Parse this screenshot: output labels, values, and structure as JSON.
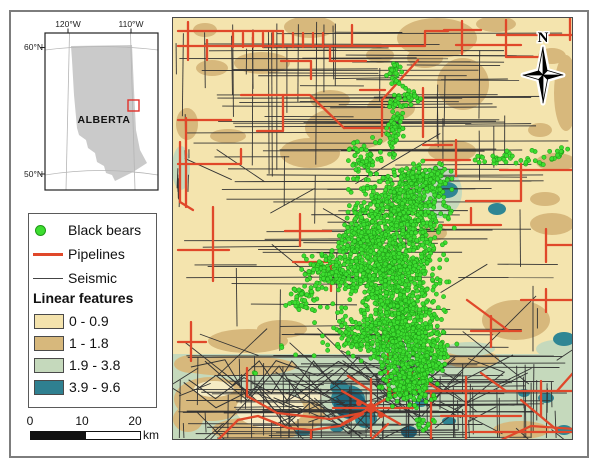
{
  "figure": {
    "border_color": "#7d7d7d",
    "background": "#ffffff"
  },
  "north": {
    "label": "N"
  },
  "inset": {
    "labels": {
      "lon_left": "120°W",
      "lon_right": "110°W",
      "lat_top": "60°N",
      "lat_bottom": "50°N",
      "province": "ALBERTA"
    },
    "province_fill": "#cacaca",
    "graticule_color": "#b5b5b5",
    "study_area_color": "#e0302a",
    "geometry": {
      "box": [
        45,
        33,
        113,
        157
      ],
      "alberta": [
        [
          71,
          46
        ],
        [
          132,
          45
        ],
        [
          134,
          90
        ],
        [
          136,
          130
        ],
        [
          140,
          150
        ],
        [
          147,
          163
        ],
        [
          133,
          172
        ],
        [
          115,
          181
        ],
        [
          112,
          175
        ],
        [
          106,
          173
        ],
        [
          104,
          166
        ],
        [
          97,
          162
        ],
        [
          95,
          153
        ],
        [
          88,
          148
        ],
        [
          86,
          140
        ],
        [
          79,
          135
        ],
        [
          77,
          128
        ],
        [
          74,
          95
        ],
        [
          72,
          60
        ]
      ],
      "study_rect": [
        128,
        100,
        11,
        11
      ]
    }
  },
  "legend": {
    "items": [
      {
        "type": "dot",
        "label": "Black bears",
        "color": "#3ddd30",
        "outline": "#1f9917"
      },
      {
        "type": "line",
        "label": "Pipelines",
        "color": "#e0482a",
        "thickness": 3
      },
      {
        "type": "line",
        "label": "Seismic",
        "color": "#444444",
        "thickness": 1
      }
    ],
    "ramp_title": "Linear features",
    "ramp": [
      {
        "label": "0 - 0.9",
        "color": "#f4e3ad"
      },
      {
        "label": "1 - 1.8",
        "color": "#d7b87c"
      },
      {
        "label": "1.9 - 3.8",
        "color": "#c5d9bc"
      },
      {
        "label": "3.9 - 9.6",
        "color": "#2f8090"
      }
    ]
  },
  "scalebar": {
    "ticks": [
      "0",
      "10",
      "20"
    ],
    "unit": "km"
  },
  "map": {
    "x": 172,
    "y": 17,
    "w": 401,
    "h": 423,
    "bg": "#f4e4ae",
    "tan": "#d7b87c",
    "green": "#c5d9bc",
    "teal": "#2f8694",
    "dark_teal": "#1c647b",
    "cream": "#f6ecc4",
    "pipeline_color": "#e0482a",
    "seismic_color": "#333333",
    "bear_fill": "#3ddd30",
    "bear_stroke": "#1f9917",
    "seed": 42,
    "green_band": [
      172,
      354,
      401,
      86
    ],
    "tan_patches": [
      [
        437,
        38,
        40,
        20
      ],
      [
        463,
        84,
        26,
        26
      ],
      [
        310,
        27,
        26,
        11
      ],
      [
        262,
        63,
        28,
        11
      ],
      [
        212,
        68,
        16,
        8
      ],
      [
        496,
        24,
        20,
        8
      ],
      [
        566,
        93,
        12,
        38
      ],
      [
        552,
        56,
        14,
        8
      ],
      [
        350,
        128,
        45,
        22
      ],
      [
        310,
        153,
        30,
        15
      ],
      [
        391,
        108,
        24,
        13
      ],
      [
        228,
        136,
        18,
        7
      ],
      [
        452,
        151,
        24,
        11
      ],
      [
        556,
        162,
        20,
        9
      ],
      [
        545,
        199,
        15,
        7
      ],
      [
        187,
        124,
        11,
        16
      ],
      [
        516,
        320,
        34,
        20
      ],
      [
        552,
        224,
        22,
        11
      ],
      [
        248,
        341,
        40,
        12
      ],
      [
        192,
        364,
        18,
        9
      ],
      [
        282,
        329,
        25,
        9
      ],
      [
        211,
        399,
        37,
        22
      ],
      [
        256,
        430,
        44,
        13
      ],
      [
        301,
        414,
        24,
        16
      ],
      [
        188,
        419,
        15,
        13
      ],
      [
        471,
        359,
        28,
        9
      ],
      [
        521,
        430,
        28,
        9
      ],
      [
        237,
        366,
        60,
        10
      ],
      [
        425,
        58,
        18,
        10
      ],
      [
        330,
        100,
        20,
        10
      ],
      [
        205,
        30,
        12,
        7
      ],
      [
        540,
        130,
        12,
        7
      ],
      [
        433,
        233,
        14,
        8
      ],
      [
        380,
        55,
        14,
        8
      ]
    ],
    "green_patches": [
      [
        181,
        168,
        9,
        22
      ],
      [
        438,
        192,
        24,
        26
      ],
      [
        556,
        349,
        20,
        9
      ],
      [
        400,
        350,
        30,
        8
      ],
      [
        470,
        349,
        25,
        7
      ]
    ],
    "cream_patches": [
      [
        270,
        409,
        34,
        19
      ],
      [
        214,
        389,
        20,
        8
      ],
      [
        310,
        396,
        12,
        6
      ]
    ],
    "teal_patches": [
      [
        348,
        399,
        17,
        14
      ],
      [
        366,
        419,
        11,
        9
      ],
      [
        339,
        387,
        9,
        7
      ],
      [
        497,
        209,
        9,
        6
      ],
      [
        447,
        190,
        11,
        8
      ],
      [
        564,
        339,
        11,
        7
      ],
      [
        546,
        398,
        8,
        5
      ],
      [
        421,
        403,
        6,
        4
      ],
      [
        449,
        421,
        7,
        4
      ],
      [
        303,
        432,
        8,
        4
      ],
      [
        524,
        393,
        6,
        4
      ],
      [
        564,
        430,
        8,
        5
      ],
      [
        337,
        428,
        7,
        4
      ]
    ],
    "dark_teal_patches": [
      [
        350,
        405,
        16,
        14
      ],
      [
        409,
        432,
        8,
        6
      ]
    ],
    "pipelines": [
      [
        178,
        46,
        392,
        46
      ],
      [
        178,
        31,
        283,
        31
      ],
      [
        188,
        22,
        188,
        60
      ],
      [
        207,
        40,
        207,
        60
      ],
      [
        233,
        33,
        233,
        47
      ],
      [
        243,
        33,
        243,
        47
      ],
      [
        253,
        33,
        253,
        47
      ],
      [
        263,
        33,
        263,
        47
      ],
      [
        273,
        33,
        273,
        47
      ],
      [
        283,
        33,
        283,
        47
      ],
      [
        293,
        33,
        293,
        47
      ],
      [
        303,
        33,
        303,
        47
      ],
      [
        313,
        33,
        313,
        47
      ],
      [
        323,
        33,
        323,
        47
      ],
      [
        330,
        46,
        330,
        61,
        366,
        61
      ],
      [
        352,
        25,
        352,
        46
      ],
      [
        392,
        46,
        425,
        46,
        425,
        31,
        448,
        31
      ],
      [
        418,
        60,
        382,
        100,
        382,
        136
      ],
      [
        281,
        61,
        311,
        61,
        311,
        79
      ],
      [
        241,
        95,
        310,
        95,
        344,
        128
      ],
      [
        283,
        95,
        283,
        131,
        257,
        131
      ],
      [
        344,
        128,
        391,
        128
      ],
      [
        360,
        90,
        385,
        90
      ],
      [
        178,
        120,
        231,
        120
      ],
      [
        186,
        118,
        186,
        207
      ],
      [
        178,
        164,
        241,
        164,
        241,
        149
      ],
      [
        213,
        207,
        213,
        281
      ],
      [
        178,
        250,
        229,
        250
      ],
      [
        497,
        35,
        575,
        35
      ],
      [
        506,
        20,
        506,
        57,
        541,
        57
      ],
      [
        462,
        21,
        462,
        54
      ],
      [
        444,
        30,
        481,
        30
      ],
      [
        456,
        45,
        521,
        45
      ],
      [
        570,
        18,
        570,
        40
      ],
      [
        500,
        170,
        575,
        170
      ],
      [
        521,
        164,
        521,
        201,
        466,
        201
      ],
      [
        546,
        229,
        546,
        262
      ],
      [
        546,
        245,
        575,
        245
      ],
      [
        521,
        300,
        575,
        300
      ],
      [
        546,
        289,
        546,
        312
      ],
      [
        300,
        214,
        300,
        246
      ],
      [
        285,
        231,
        331,
        231
      ],
      [
        293,
        262,
        331,
        262,
        331,
        291
      ],
      [
        456,
        140,
        456,
        176
      ],
      [
        423,
        160,
        470,
        160
      ],
      [
        423,
        145,
        452,
        145
      ],
      [
        423,
        137,
        423,
        88
      ],
      [
        441,
        225,
        501,
        225
      ],
      [
        471,
        208,
        471,
        225
      ],
      [
        467,
        300,
        509,
        331
      ],
      [
        471,
        331,
        521,
        331
      ],
      [
        491,
        316,
        491,
        347
      ],
      [
        178,
        342,
        206,
        342
      ],
      [
        191,
        322,
        191,
        361
      ],
      [
        247,
        368,
        247,
        396,
        277,
        413,
        330,
        419,
        362,
        413
      ],
      [
        218,
        440,
        238,
        420,
        258,
        416,
        288,
        428,
        311,
        430,
        311,
        442
      ],
      [
        311,
        430,
        340,
        426,
        363,
        414
      ],
      [
        388,
        334,
        388,
        392
      ],
      [
        342,
        391,
        400,
        424
      ],
      [
        342,
        424,
        400,
        391
      ],
      [
        371,
        379,
        371,
        436
      ],
      [
        333,
        408,
        413,
        408
      ],
      [
        388,
        391,
        575,
        391
      ],
      [
        431,
        391,
        431,
        440
      ],
      [
        466,
        377,
        466,
        440
      ],
      [
        441,
        416,
        521,
        416
      ],
      [
        521,
        400,
        557,
        430
      ],
      [
        471,
        432,
        575,
        432
      ],
      [
        541,
        381,
        541,
        416
      ],
      [
        557,
        391,
        573,
        373
      ],
      [
        409,
        371,
        441,
        391
      ],
      [
        481,
        373,
        506,
        391
      ],
      [
        348,
        376,
        371,
        391
      ],
      [
        501,
        440,
        531,
        426,
        575,
        429
      ],
      [
        371,
        440,
        388,
        424
      ],
      [
        180,
        142,
        180,
        202
      ],
      [
        180,
        202,
        193,
        210
      ]
    ],
    "pipeline_hubs": [
      [
        371,
        408,
        5
      ],
      [
        359,
        403,
        3
      ],
      [
        381,
        415,
        3
      ]
    ],
    "seismic": {
      "seed": 1337,
      "h_regions": [
        {
          "x0": 175,
          "x1": 571,
          "y0": 21,
          "y1": 208,
          "n": 55,
          "lmin": 60,
          "lmax": 320
        },
        {
          "x0": 175,
          "x1": 571,
          "y0": 208,
          "y1": 350,
          "n": 30,
          "lmin": 40,
          "lmax": 200
        },
        {
          "x0": 175,
          "x1": 571,
          "y0": 354,
          "y1": 438,
          "n": 46,
          "lmin": 50,
          "lmax": 380
        }
      ],
      "v_regions": [
        {
          "x0": 183,
          "x1": 345,
          "y0": 20,
          "y1": 40,
          "n": 13,
          "lmin": 50,
          "lmax": 150
        },
        {
          "x0": 175,
          "x1": 568,
          "y0": 25,
          "y1": 330,
          "n": 26,
          "lmin": 15,
          "lmax": 70
        },
        {
          "x0": 175,
          "x1": 568,
          "y0": 354,
          "y1": 425,
          "n": 60,
          "lmin": 15,
          "lmax": 75
        },
        {
          "x0": 174,
          "x1": 190,
          "y0": 148,
          "y1": 186,
          "n": 8,
          "lmin": 8,
          "lmax": 25
        }
      ],
      "d_regions": [
        {
          "x0": 180,
          "x1": 560,
          "y0": 120,
          "y1": 345,
          "n": 10,
          "lmin": 40,
          "lmax": 90
        },
        {
          "x0": 175,
          "x1": 565,
          "y0": 354,
          "y1": 430,
          "n": 45,
          "lmin": 25,
          "lmax": 90
        }
      ],
      "zigzags": {
        "n": 5,
        "x0": 176,
        "segs": 9
      }
    },
    "bear_clusters": [
      [
        400,
        212,
        58,
        40,
        520
      ],
      [
        392,
        268,
        55,
        42,
        560
      ],
      [
        402,
        330,
        46,
        40,
        500
      ],
      [
        408,
        382,
        30,
        26,
        240
      ],
      [
        333,
        272,
        34,
        24,
        150
      ],
      [
        362,
        240,
        28,
        22,
        130
      ],
      [
        422,
        180,
        33,
        20,
        150
      ],
      [
        395,
        122,
        10,
        38,
        70
      ],
      [
        394,
        73,
        10,
        12,
        30
      ],
      [
        510,
        160,
        46,
        12,
        36
      ],
      [
        557,
        153,
        14,
        9,
        14
      ],
      [
        302,
        300,
        20,
        14,
        40
      ],
      [
        382,
        308,
        78,
        58,
        140
      ],
      [
        430,
        358,
        26,
        20,
        90
      ],
      [
        356,
        335,
        24,
        18,
        70
      ],
      [
        420,
        424,
        16,
        8,
        14
      ],
      [
        366,
        160,
        20,
        25,
        60
      ],
      [
        282,
        346,
        3,
        3,
        2
      ],
      [
        253,
        372,
        3,
        3,
        2
      ],
      [
        295,
        355,
        2,
        2,
        1
      ],
      [
        411,
        96,
        12,
        10,
        20
      ]
    ]
  }
}
